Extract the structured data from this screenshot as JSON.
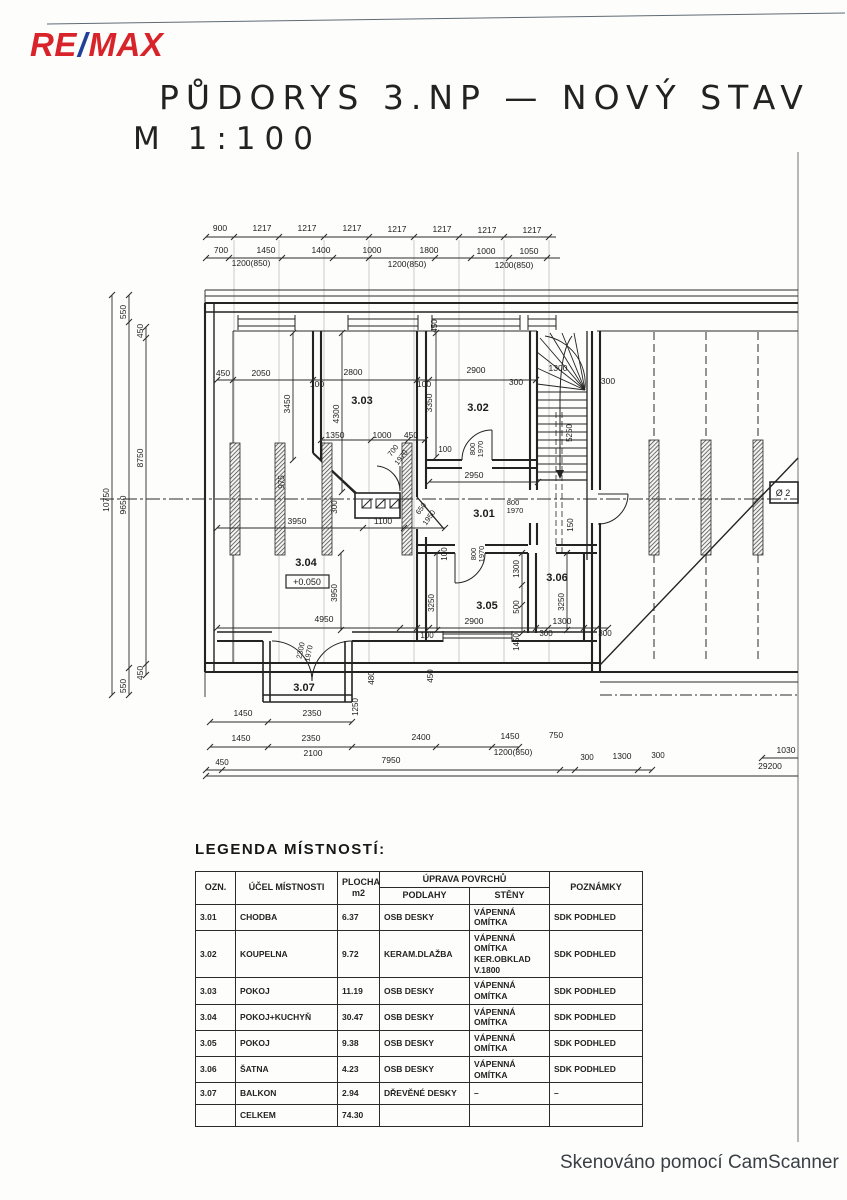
{
  "header": {
    "logo_re": "RE",
    "logo_slash": "/",
    "logo_max": "MAX",
    "title_line1": "PŮDORYS 3.NP — NOVÝ STAV",
    "title_line2": "M 1:100"
  },
  "legend": {
    "heading": "LEGENDA MÍSTNOSTÍ:",
    "columns": {
      "ozn": "OZN.",
      "ucel": "ÚČEL MÍSTNOSTI",
      "plocha": "PLOCHA\nm2",
      "uprava": "ÚPRAVA POVRCHŮ",
      "podlahy": "PODLAHY",
      "steny": "STĚNY",
      "poznamky": "POZNÁMKY"
    },
    "rows": [
      [
        "3.01",
        "CHODBA",
        "6.37",
        "OSB DESKY",
        "VÁPENNÁ OMÍTKA",
        "SDK PODHLED"
      ],
      [
        "3.02",
        "KOUPELNA",
        "9.72",
        "KERAM.DLAŽBA",
        "VÁPENNÁ OMÍTKA\nKER.OBKLAD V.1800",
        "SDK PODHLED"
      ],
      [
        "3.03",
        "POKOJ",
        "11.19",
        "OSB DESKY",
        "VÁPENNÁ OMÍTKA",
        "SDK PODHLED"
      ],
      [
        "3.04",
        "POKOJ+KUCHYŇ",
        "30.47",
        "OSB DESKY",
        "VÁPENNÁ OMÍTKA",
        "SDK PODHLED"
      ],
      [
        "3.05",
        "POKOJ",
        "9.38",
        "OSB DESKY",
        "VÁPENNÁ OMÍTKA",
        "SDK PODHLED"
      ],
      [
        "3.06",
        "ŠATNA",
        "4.23",
        "OSB DESKY",
        "VÁPENNÁ OMÍTKA",
        "SDK PODHLED"
      ],
      [
        "3.07",
        "BALKON",
        "2.94",
        "DŘEVĚNÉ DESKY",
        "–",
        "–"
      ],
      [
        "",
        "CELKEM",
        "74.30",
        "",
        "",
        ""
      ]
    ]
  },
  "plan": {
    "labels": [
      {
        "t": "900",
        "x": 220,
        "y": 231
      },
      {
        "t": "1217",
        "x": 262,
        "y": 231
      },
      {
        "t": "1217",
        "x": 307,
        "y": 231
      },
      {
        "t": "1217",
        "x": 352,
        "y": 231
      },
      {
        "t": "1217",
        "x": 397,
        "y": 232
      },
      {
        "t": "1217",
        "x": 442,
        "y": 232
      },
      {
        "t": "1217",
        "x": 487,
        "y": 233
      },
      {
        "t": "1217",
        "x": 532,
        "y": 233
      },
      {
        "t": "700",
        "x": 221,
        "y": 253
      },
      {
        "t": "1450",
        "x": 266,
        "y": 253
      },
      {
        "t": "1400",
        "x": 321,
        "y": 253
      },
      {
        "t": "1000",
        "x": 372,
        "y": 253
      },
      {
        "t": "1800",
        "x": 429,
        "y": 253
      },
      {
        "t": "1000",
        "x": 486,
        "y": 254
      },
      {
        "t": "1050",
        "x": 529,
        "y": 254
      },
      {
        "t": "1200(850)",
        "x": 251,
        "y": 266
      },
      {
        "t": "1200(850)",
        "x": 407,
        "y": 267
      },
      {
        "t": "1200(850)",
        "x": 514,
        "y": 268
      },
      {
        "t": "10750",
        "x": 109,
        "y": 500,
        "r": -90
      },
      {
        "t": "550",
        "x": 126,
        "y": 312,
        "r": -90
      },
      {
        "t": "9650",
        "x": 126,
        "y": 505,
        "r": -90
      },
      {
        "t": "550",
        "x": 126,
        "y": 686,
        "r": -90
      },
      {
        "t": "450",
        "x": 143,
        "y": 331,
        "r": -90
      },
      {
        "t": "8750",
        "x": 143,
        "y": 458,
        "r": -90
      },
      {
        "t": "450",
        "x": 143,
        "y": 673,
        "r": -90
      },
      {
        "t": "450",
        "x": 223,
        "y": 376
      },
      {
        "t": "2050",
        "x": 261,
        "y": 376
      },
      {
        "t": "2800",
        "x": 353,
        "y": 375
      },
      {
        "t": "2900",
        "x": 476,
        "y": 373
      },
      {
        "t": "300",
        "x": 516,
        "y": 385
      },
      {
        "t": "1300",
        "x": 558,
        "y": 371
      },
      {
        "t": "300",
        "x": 608,
        "y": 384
      },
      {
        "t": "100",
        "x": 317,
        "y": 387
      },
      {
        "t": "100",
        "x": 424,
        "y": 387
      },
      {
        "t": "3450",
        "x": 290,
        "y": 404,
        "r": -90
      },
      {
        "t": "4300",
        "x": 339,
        "y": 414,
        "r": -90
      },
      {
        "t": "3350",
        "x": 432,
        "y": 403,
        "r": -90
      },
      {
        "t": "3.03",
        "x": 362,
        "y": 404,
        "b": 1,
        "s": 11
      },
      {
        "t": "3.02",
        "x": 478,
        "y": 411,
        "b": 1,
        "s": 11
      },
      {
        "t": "1350",
        "x": 335,
        "y": 438
      },
      {
        "t": "1000",
        "x": 382,
        "y": 438
      },
      {
        "t": "450",
        "x": 411,
        "y": 438
      },
      {
        "t": "700",
        "x": 395,
        "y": 452,
        "r": -52,
        "s": 7.5
      },
      {
        "t": "1970",
        "x": 403,
        "y": 459,
        "r": -52,
        "s": 7.5
      },
      {
        "t": "800",
        "x": 475,
        "y": 449,
        "r": -90,
        "s": 7.5
      },
      {
        "t": "1970",
        "x": 483,
        "y": 449,
        "r": -90,
        "s": 7.5
      },
      {
        "t": "100",
        "x": 445,
        "y": 452,
        "s": 8
      },
      {
        "t": "2950",
        "x": 474,
        "y": 478
      },
      {
        "t": "975",
        "x": 284,
        "y": 482,
        "r": -90,
        "s": 8
      },
      {
        "t": "300",
        "x": 337,
        "y": 507,
        "r": -90,
        "s": 8
      },
      {
        "t": "3950",
        "x": 297,
        "y": 524
      },
      {
        "t": "1100",
        "x": 383,
        "y": 524
      },
      {
        "t": "650",
        "x": 423,
        "y": 510,
        "r": -55,
        "s": 7.5
      },
      {
        "t": "1950",
        "x": 431,
        "y": 519,
        "r": -55,
        "s": 7.5
      },
      {
        "t": "3.01",
        "x": 484,
        "y": 517,
        "b": 1,
        "s": 11
      },
      {
        "t": "800",
        "x": 513,
        "y": 505,
        "s": 7.5
      },
      {
        "t": "1970",
        "x": 515,
        "y": 513,
        "s": 7.5
      },
      {
        "t": "150",
        "x": 573,
        "y": 525,
        "r": -90,
        "s": 8
      },
      {
        "t": "5250",
        "x": 572,
        "y": 433,
        "r": -90,
        "s": 8
      },
      {
        "t": "450",
        "x": 437,
        "y": 326,
        "r": -90,
        "s": 8
      },
      {
        "t": "800",
        "x": 476,
        "y": 554,
        "r": -90,
        "s": 7.5
      },
      {
        "t": "1970",
        "x": 484,
        "y": 554,
        "r": -90,
        "s": 7.5
      },
      {
        "t": "100",
        "x": 447,
        "y": 554,
        "r": -90,
        "s": 8
      },
      {
        "t": "1300",
        "x": 519,
        "y": 569,
        "r": -90,
        "s": 8
      },
      {
        "t": "500",
        "x": 519,
        "y": 607,
        "r": -90,
        "s": 8
      },
      {
        "t": "1450",
        "x": 519,
        "y": 642,
        "r": -90,
        "s": 8
      },
      {
        "t": "3.06",
        "x": 557,
        "y": 581,
        "b": 1,
        "s": 11
      },
      {
        "t": "3250",
        "x": 434,
        "y": 603,
        "r": -90,
        "s": 8
      },
      {
        "t": "3250",
        "x": 564,
        "y": 602,
        "r": -90,
        "s": 8
      },
      {
        "t": "3.05",
        "x": 487,
        "y": 609,
        "b": 1,
        "s": 11
      },
      {
        "t": "3.04",
        "x": 306,
        "y": 566,
        "b": 1,
        "s": 11
      },
      {
        "t": "+0.050",
        "x": 307,
        "y": 585,
        "s": 9
      },
      {
        "t": "3950",
        "x": 337,
        "y": 593,
        "r": -90,
        "s": 8
      },
      {
        "t": "4950",
        "x": 324,
        "y": 622
      },
      {
        "t": "2900",
        "x": 474,
        "y": 624
      },
      {
        "t": "1300",
        "x": 562,
        "y": 624
      },
      {
        "t": "100",
        "x": 427,
        "y": 638,
        "s": 8
      },
      {
        "t": "300",
        "x": 546,
        "y": 636,
        "s": 8
      },
      {
        "t": "300",
        "x": 605,
        "y": 636,
        "s": 8
      },
      {
        "t": "2300",
        "x": 303,
        "y": 651,
        "r": -78,
        "s": 7.5
      },
      {
        "t": "1970",
        "x": 311,
        "y": 654,
        "r": -78,
        "s": 7.5
      },
      {
        "t": "480",
        "x": 374,
        "y": 678,
        "r": -90,
        "s": 8
      },
      {
        "t": "450",
        "x": 433,
        "y": 676,
        "r": -90,
        "s": 8
      },
      {
        "t": "1250",
        "x": 358,
        "y": 707,
        "r": -90,
        "s": 8
      },
      {
        "t": "3.07",
        "x": 304,
        "y": 691,
        "b": 1,
        "s": 11
      },
      {
        "t": "Ø 2",
        "x": 783,
        "y": 496,
        "s": 9
      },
      {
        "t": "1450",
        "x": 243,
        "y": 716
      },
      {
        "t": "2350",
        "x": 312,
        "y": 716
      },
      {
        "t": "1450",
        "x": 241,
        "y": 741
      },
      {
        "t": "2350",
        "x": 311,
        "y": 741
      },
      {
        "t": "2400",
        "x": 421,
        "y": 740
      },
      {
        "t": "1450",
        "x": 510,
        "y": 739
      },
      {
        "t": "750",
        "x": 556,
        "y": 738
      },
      {
        "t": "2100",
        "x": 313,
        "y": 756
      },
      {
        "t": "1200(850)",
        "x": 513,
        "y": 755
      },
      {
        "t": "450",
        "x": 222,
        "y": 765,
        "s": 8
      },
      {
        "t": "7950",
        "x": 391,
        "y": 763
      },
      {
        "t": "300",
        "x": 587,
        "y": 760,
        "s": 8
      },
      {
        "t": "1300",
        "x": 622,
        "y": 759
      },
      {
        "t": "300",
        "x": 658,
        "y": 758,
        "s": 8
      },
      {
        "t": "1030",
        "x": 786,
        "y": 753
      },
      {
        "t": "29200",
        "x": 770,
        "y": 769
      }
    ]
  },
  "footer": {
    "scan_note": "Skenováno pomocí CamScanner"
  },
  "colors": {
    "remax_red": "#d8232a",
    "remax_blue": "#21409a",
    "ink": "#222222",
    "paper": "#fdfdfc"
  }
}
